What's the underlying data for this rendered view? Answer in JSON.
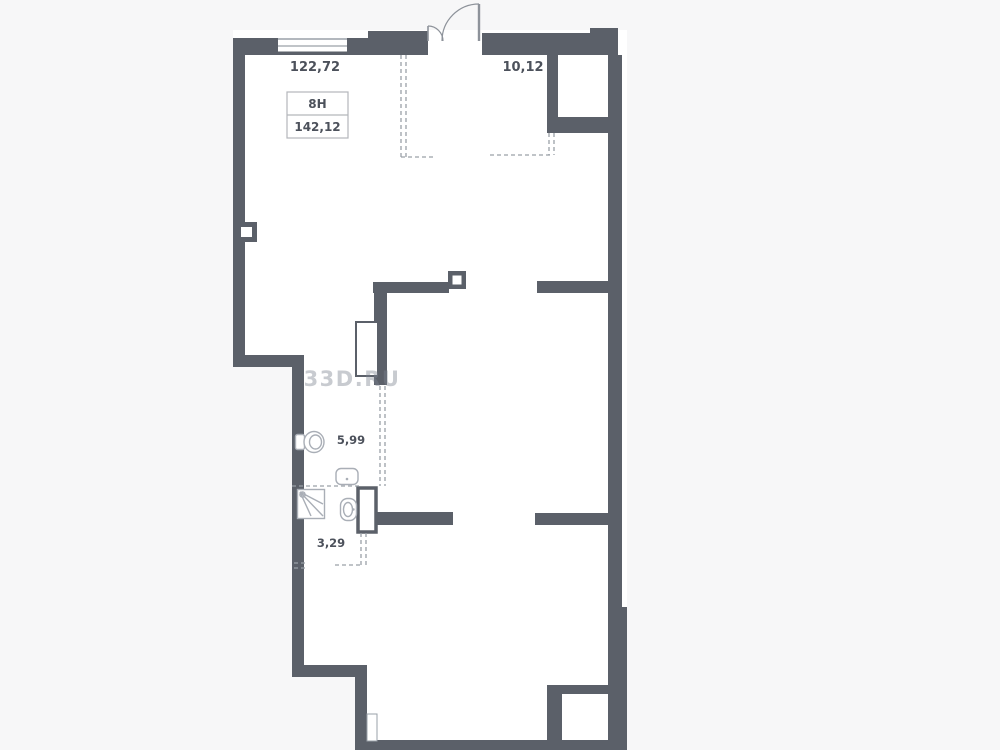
{
  "plan": {
    "unit_label": "8Н",
    "total_area": "142,12",
    "rooms": [
      {
        "id": "main-room",
        "area": "122,72"
      },
      {
        "id": "entry-zone",
        "area": "10,12"
      },
      {
        "id": "bathroom-large",
        "area": "5,99"
      },
      {
        "id": "bathroom-small",
        "area": "3,29"
      }
    ],
    "watermark": "33D.RU",
    "colors": {
      "wall": "#5b6069",
      "fixture_outline": "#a9aeb6",
      "dashed_line": "#9aa0a8",
      "text": "#4c515b",
      "watermark": "#c7c9cd",
      "background": "#f7f7f8",
      "room_fill": "#ffffff"
    }
  }
}
